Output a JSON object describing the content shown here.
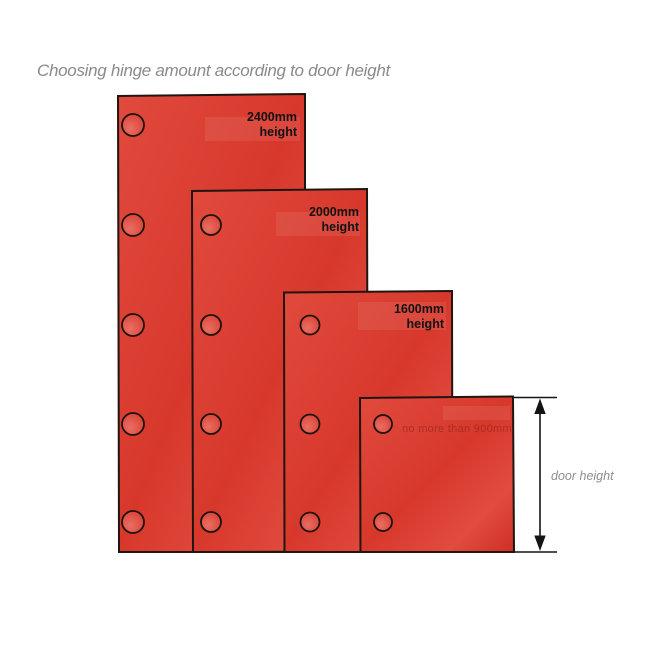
{
  "title": "Choosing hinge amount according to door height",
  "doors": [
    {
      "height_label": "2400mm",
      "height_suffix": "height",
      "hinge_count": 5
    },
    {
      "height_label": "2000mm",
      "height_suffix": "height",
      "hinge_count": 4
    },
    {
      "height_label": "1600mm",
      "height_suffix": "height",
      "hinge_count": 3
    },
    {
      "note": "no more than 900mm",
      "hinge_count": 2
    }
  ],
  "dimension": {
    "label": "door height"
  },
  "colors": {
    "door_fill": "#d8382c",
    "door_fill_light": "#e04c3e",
    "door_border": "#201511",
    "hinge_outline": "#1c120e",
    "title_text": "#8a8a8a",
    "label_text": "#121212",
    "note_text": "#7d1f17",
    "dimension_line": "#141414"
  }
}
